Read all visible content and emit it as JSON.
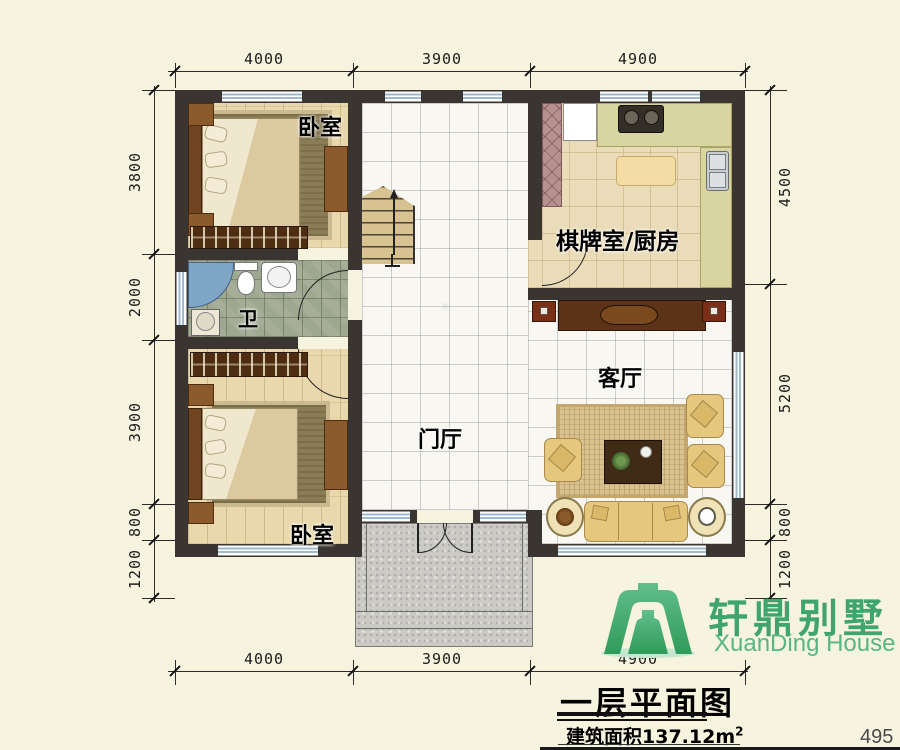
{
  "meta": {
    "accent_green": "#3FA56E",
    "wall_color": "#3A3530",
    "window_blue": "#9FB9D0"
  },
  "dims": {
    "top": [
      "4000",
      "3900",
      "4900"
    ],
    "bottom": [
      "4000",
      "3900",
      "4900"
    ],
    "left": [
      "3800",
      "2000",
      "3900",
      "800",
      "1200"
    ],
    "right": [
      "4500",
      "5200",
      "800",
      "1200"
    ]
  },
  "rooms": {
    "bedroom_top": "卧室",
    "kitchen": "棋牌室/厨房",
    "bathroom": "卫",
    "foyer": "门厅",
    "living": "客厅",
    "bedroom_bottom": "卧室"
  },
  "logo": {
    "name_cn": "轩鼎别墅",
    "name_en": "XuanDing House"
  },
  "titleblock": {
    "title": "一层平面图",
    "area_text": "建筑面积137.12m",
    "area_sup": "2",
    "page_number": "495"
  }
}
